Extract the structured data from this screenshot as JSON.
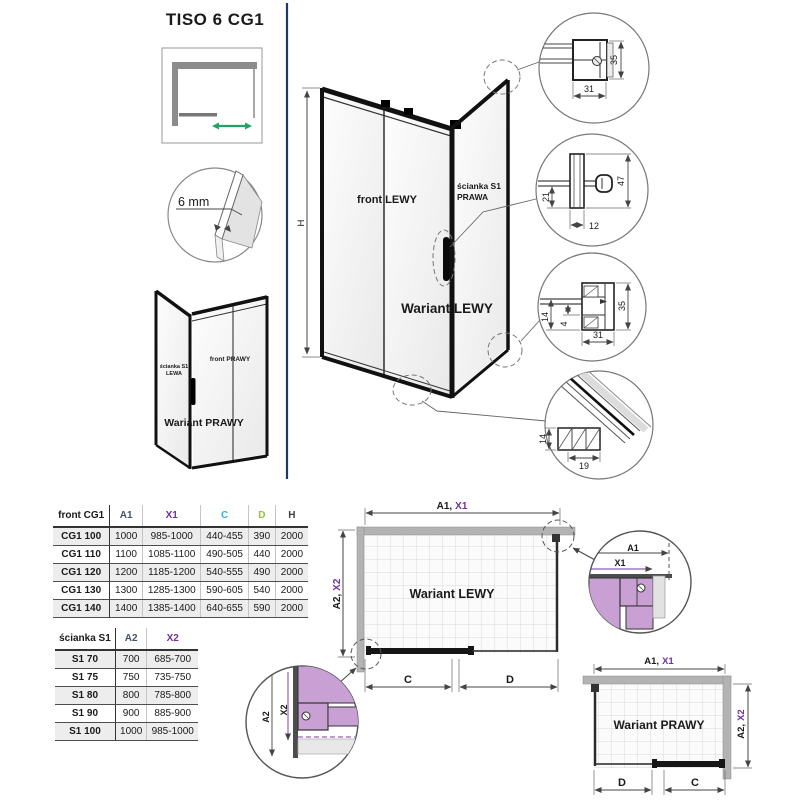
{
  "page": {
    "title": "TISO 6 CG1"
  },
  "glass_detail": {
    "label": "6 mm"
  },
  "small_view": {
    "wall_line1": "ścianka S1",
    "wall_line2": "LEWA",
    "front": "front PRAWY",
    "variant": "Wariant PRAWY"
  },
  "main_view": {
    "front": "front LEWY",
    "wall_line1": "ścianka S1",
    "wall_line2": "PRAWA",
    "variant": "Wariant LEWY",
    "height": "H"
  },
  "details": {
    "top_profile": {
      "w": "31",
      "h": "35"
    },
    "knob": {
      "a": "21",
      "b": "12",
      "c": "47"
    },
    "wall_bottom": {
      "a": "14",
      "b": "4",
      "c": "31",
      "d": "35"
    },
    "rail": {
      "a": "14",
      "b": "19"
    }
  },
  "plan_left": {
    "variant": "Wariant LEWY",
    "dim_a1": "A1,",
    "dim_x1": "X1",
    "dim_a2": "A2,",
    "dim_x2": "X2",
    "dim_c": "C",
    "dim_d": "D"
  },
  "plan_right": {
    "variant": "Wariant PRAWY",
    "dim_a1": "A1,",
    "dim_x1": "X1",
    "dim_a2": "A2,",
    "dim_x2": "X2",
    "dim_c": "C",
    "dim_d": "D"
  },
  "corner_detail_top": {
    "a1": "A1",
    "x1": "X1"
  },
  "corner_detail_bottom": {
    "a2": "A2",
    "x2": "X2"
  },
  "colors": {
    "purple": "#7030A0",
    "cyan": "#31B5E8",
    "green": "#8DC63F",
    "navy_divider": "#1F3864",
    "violet_fill": "#C9A0D4",
    "arrow_green": "#21A366"
  },
  "table_front": {
    "title": "front CG1",
    "headers": [
      "A1",
      "X1",
      "C",
      "D",
      "H"
    ],
    "rows": [
      {
        "name": "CG1 100",
        "values": [
          "1000",
          "985-1000",
          "440-455",
          "390",
          "2000"
        ]
      },
      {
        "name": "CG1 110",
        "values": [
          "1100",
          "1085-1100",
          "490-505",
          "440",
          "2000"
        ]
      },
      {
        "name": "CG1 120",
        "values": [
          "1200",
          "1185-1200",
          "540-555",
          "490",
          "2000"
        ]
      },
      {
        "name": "CG1 130",
        "values": [
          "1300",
          "1285-1300",
          "590-605",
          "540",
          "2000"
        ]
      },
      {
        "name": "CG1 140",
        "values": [
          "1400",
          "1385-1400",
          "640-655",
          "590",
          "2000"
        ]
      }
    ]
  },
  "table_wall": {
    "title": "ścianka S1",
    "headers": [
      "A2",
      "X2"
    ],
    "rows": [
      {
        "name": "S1 70",
        "values": [
          "700",
          "685-700"
        ]
      },
      {
        "name": "S1 75",
        "values": [
          "750",
          "735-750"
        ]
      },
      {
        "name": "S1 80",
        "values": [
          "800",
          "785-800"
        ]
      },
      {
        "name": "S1 90",
        "values": [
          "900",
          "885-900"
        ]
      },
      {
        "name": "S1 100",
        "values": [
          "1000",
          "985-1000"
        ]
      }
    ]
  }
}
